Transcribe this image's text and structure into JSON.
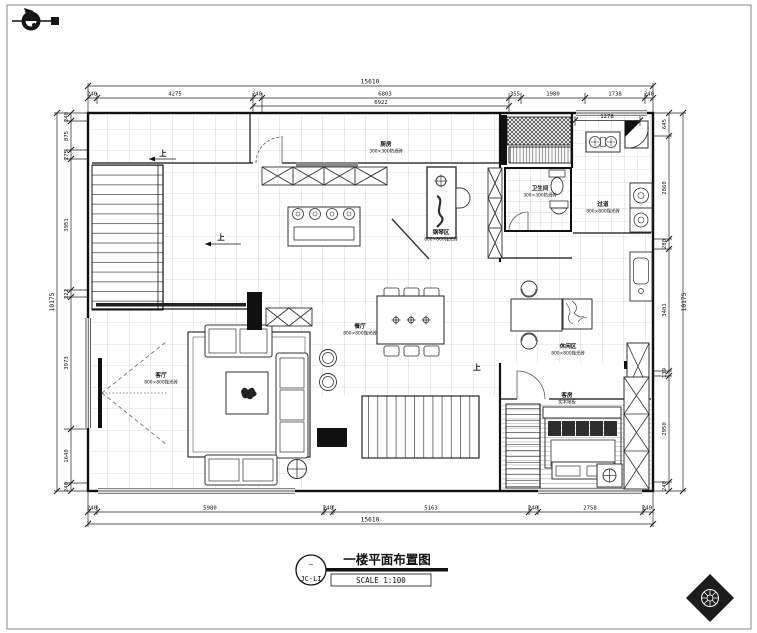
{
  "meta": {
    "background": "#ffffff",
    "line_color": "#1a1a1a"
  },
  "north_arrow": {
    "label": "north-indicator"
  },
  "title_block": {
    "bubble_top": "—",
    "bubble_code": "JC-LI",
    "title": "一楼平面布置图",
    "scale": "SCALE 1:100"
  },
  "dimensions": {
    "top": {
      "total": "15610",
      "chain": [
        "240",
        "4275",
        "240",
        "6803",
        "355",
        "1980",
        "1738",
        "240"
      ],
      "sub": "6922",
      "sub2": "1278"
    },
    "bottom": {
      "total": "15610",
      "chain": [
        "240",
        "5980",
        "240",
        "5163",
        "240",
        "2758",
        "240"
      ]
    },
    "left": {
      "total": "10175",
      "chain": [
        "240",
        "875",
        "275",
        "3951",
        "222",
        "3973",
        "1640",
        "240"
      ]
    },
    "right": {
      "total": "10175",
      "chain": [
        "645",
        "2860",
        "280",
        "3401",
        "139",
        "2950",
        "240"
      ]
    }
  },
  "rooms": {
    "kitchen": {
      "name": "厨房",
      "finish": "300×300防滑砖"
    },
    "piano": {
      "name": "钢琴区",
      "finish": "800×800抛光砖"
    },
    "bath": {
      "name": "卫生间",
      "finish": "300×300防滑砖"
    },
    "hall": {
      "name": "过道",
      "finish": "800×800抛光砖"
    },
    "dining": {
      "name": "餐厅",
      "finish": "800×800抛光砖"
    },
    "living": {
      "name": "客厅",
      "finish": "800×800抛光砖"
    },
    "leisure": {
      "name": "休闲区",
      "finish": "800×800抛光砖"
    },
    "bedroom": {
      "name": "客房",
      "finish": "实木地板"
    }
  },
  "annotations": {
    "up1": "上",
    "up2": "上",
    "up3": "上"
  }
}
